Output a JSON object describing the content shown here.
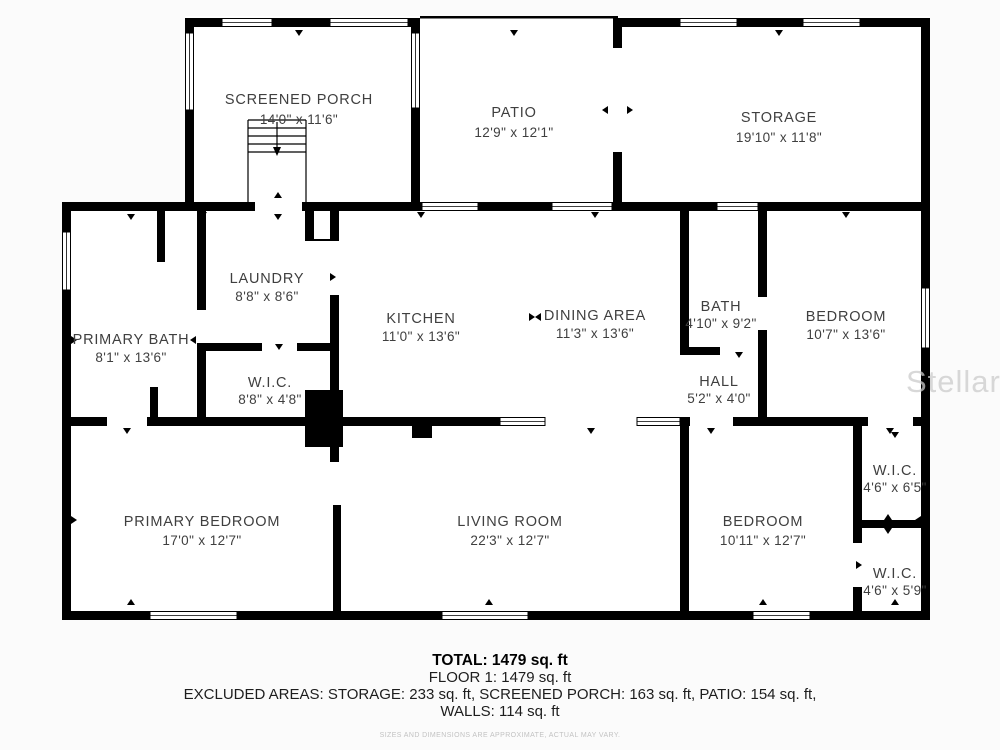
{
  "floorplan": {
    "rooms": [
      {
        "name": "SCREENED PORCH",
        "dims": "14'0\" x 11'6\""
      },
      {
        "name": "PATIO",
        "dims": "12'9\" x 12'1\""
      },
      {
        "name": "STORAGE",
        "dims": "19'10\" x 11'8\""
      },
      {
        "name": "LAUNDRY",
        "dims": "8'8\" x 8'6\""
      },
      {
        "name": "PRIMARY BATH",
        "dims": "8'1\" x 13'6\""
      },
      {
        "name": "KITCHEN",
        "dims": "11'0\" x 13'6\""
      },
      {
        "name": "DINING AREA",
        "dims": "11'3\" x 13'6\""
      },
      {
        "name": "BATH",
        "dims": "4'10\" x 9'2\""
      },
      {
        "name": "BEDROOM",
        "dims": "10'7\" x 13'6\""
      },
      {
        "name": "HALL",
        "dims": "5'2\" x 4'0\""
      },
      {
        "name": "W.I.C.",
        "dims": "8'8\" x 4'8\""
      },
      {
        "name": "PRIMARY BEDROOM",
        "dims": "17'0\" x 12'7\""
      },
      {
        "name": "LIVING ROOM",
        "dims": "22'3\" x 12'7\""
      },
      {
        "name": "BEDROOM",
        "dims": "10'11\" x 12'7\""
      },
      {
        "name": "W.I.C.",
        "dims": "4'6\" x 6'5\""
      },
      {
        "name": "W.I.C.",
        "dims": "4'6\" x 5'9\""
      }
    ],
    "summary": {
      "total": "TOTAL: 1479 sq. ft",
      "floor": "FLOOR 1: 1479 sq. ft",
      "excluded": "EXCLUDED AREAS: STORAGE: 233 sq. ft, SCREENED PORCH: 163 sq. ft, PATIO: 154 sq. ft,",
      "walls": "WALLS: 114 sq. ft",
      "disclaimer": "SIZES AND DIMENSIONS ARE APPROXIMATE, ACTUAL MAY VARY."
    },
    "watermark": "StellarMLS"
  },
  "colors": {
    "wall": "#000000",
    "label": "#3f3f3f",
    "watermark": "#cccccc",
    "background": "#fbfbfb",
    "room": "#ffffff",
    "disclaimer": "#c2c2c2"
  }
}
